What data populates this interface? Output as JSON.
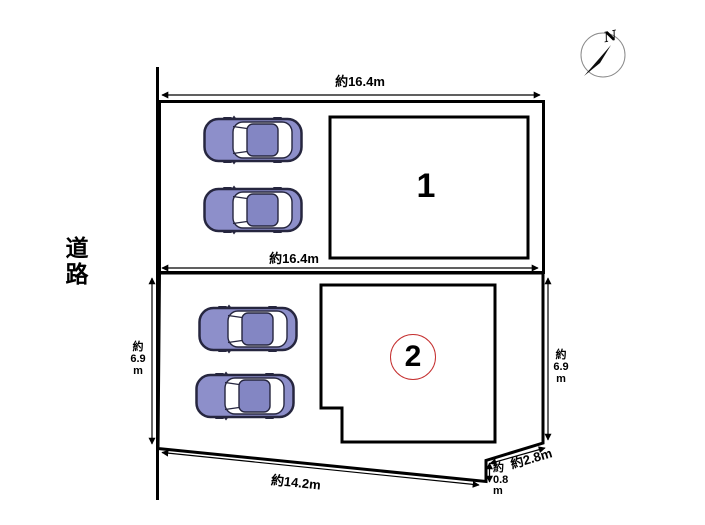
{
  "road": {
    "label": "道路"
  },
  "compass": {
    "north": "N"
  },
  "lot1": {
    "building_number": "1",
    "top_width": "約16.4m",
    "bottom_width": "約16.4m",
    "cars": 2
  },
  "lot2": {
    "building_number": "2",
    "left_depth": [
      "約",
      "6.9",
      "m"
    ],
    "right_depth": [
      "約",
      "6.9",
      "m"
    ],
    "bottom_width": "約14.2m",
    "diagonal_width": "約2.8m",
    "notch_depth": [
      "約",
      "0.8",
      "m"
    ],
    "cars": 2
  },
  "colors": {
    "line": "#000000",
    "car_body": "#8d8fca",
    "car_roof": "#8386c3",
    "car_glass": "#ffffff",
    "car_outline": "#26263f",
    "circle_accent": "#c53030",
    "compass_ring": "#8a8a8a"
  }
}
